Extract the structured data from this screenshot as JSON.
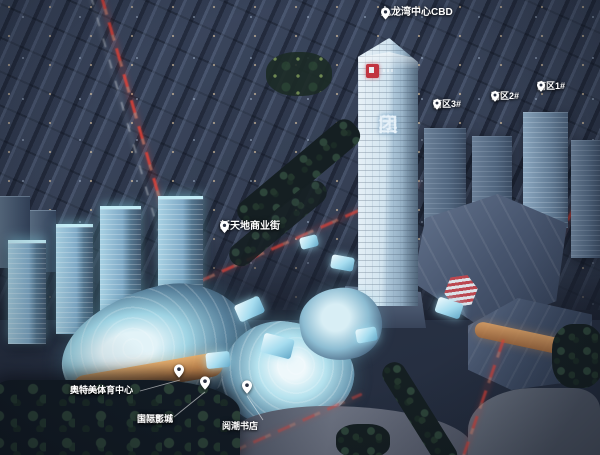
{
  "scene": {
    "description": "Dusk aerial rendering of Huafa mixed-use development with labeled landmarks",
    "colors": {
      "base_dark": "#232b3a",
      "city_block": "#3c4759",
      "glow_cyan": "#9fdcec",
      "tower_glass": "#d2e4ef",
      "warm_light": "#e8a868",
      "traffic_red": "#e04a44",
      "tree_green": "#2c4238",
      "label_white": "#ffffff",
      "logo_red": "#c13440"
    }
  },
  "labels": {
    "cbd": "九龙湾中心CBD",
    "south_block_1": "南区1#",
    "south_block_2": "南区2#",
    "south_block_3": "南区3#",
    "commercial_street": "新天地商业街",
    "sports_center_en": "Ultimate",
    "sports_center_cn": "奥特美体育中心",
    "cinema_line1": "幸福蓝海",
    "cinema_line2": "国际影城",
    "bookstore": "阅潮书店"
  },
  "tower_sign": {
    "c0": "华",
    "c1": "发",
    "c2": "集",
    "c3": "团"
  }
}
